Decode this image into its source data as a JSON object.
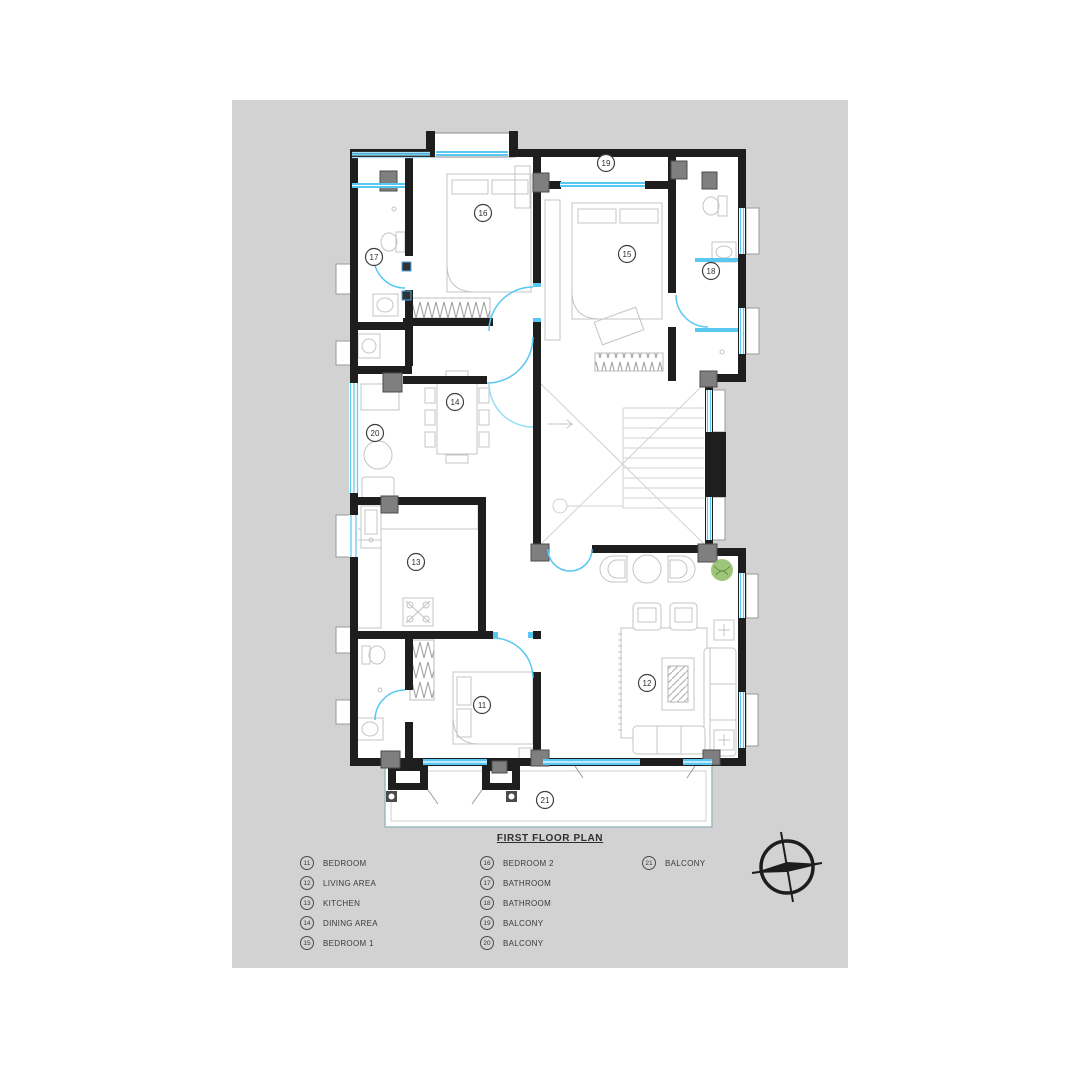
{
  "page": {
    "title": "FIRST FLOOR PLAN"
  },
  "plan": {
    "rooms": [
      {
        "num": "11",
        "label": "BEDROOM",
        "x": 482,
        "y": 705
      },
      {
        "num": "12",
        "label": "LIVING AREA",
        "x": 647,
        "y": 683
      },
      {
        "num": "13",
        "label": "KITCHEN",
        "x": 416,
        "y": 562
      },
      {
        "num": "14",
        "label": "DINING AREA",
        "x": 455,
        "y": 402
      },
      {
        "num": "15",
        "label": "BEDROOM 1",
        "x": 627,
        "y": 254
      },
      {
        "num": "16",
        "label": "BEDROOM 2",
        "x": 483,
        "y": 213
      },
      {
        "num": "17",
        "label": "BATHROOM",
        "x": 374,
        "y": 257
      },
      {
        "num": "18",
        "label": "BATHROOM",
        "x": 711,
        "y": 271
      },
      {
        "num": "19",
        "label": "BALCONY",
        "x": 606,
        "y": 163
      },
      {
        "num": "20",
        "label": "BALCONY",
        "x": 375,
        "y": 433
      },
      {
        "num": "21",
        "label": "BALCONY",
        "x": 545,
        "y": 800
      }
    ]
  },
  "legend": {
    "columns": [
      {
        "items": [
          {
            "num": "11",
            "label": "BEDROOM"
          },
          {
            "num": "12",
            "label": "LIVING AREA"
          },
          {
            "num": "13",
            "label": "KITCHEN"
          },
          {
            "num": "14",
            "label": "DINING AREA"
          },
          {
            "num": "15",
            "label": "BEDROOM 1"
          }
        ]
      },
      {
        "items": [
          {
            "num": "16",
            "label": "BEDROOM 2"
          },
          {
            "num": "17",
            "label": "BATHROOM"
          },
          {
            "num": "18",
            "label": "BATHROOM"
          },
          {
            "num": "19",
            "label": "BALCONY"
          },
          {
            "num": "20",
            "label": "BALCONY"
          }
        ]
      },
      {
        "items": [
          {
            "num": "21",
            "label": "BALCONY"
          }
        ]
      }
    ]
  },
  "colors": {
    "paper": "#d2d2d2",
    "wall": "#1e1e1e",
    "window": "#58c8f2",
    "window_light": "#a8e0f7",
    "column": "#7f7f7f",
    "furniture": "#c4c4c4",
    "stair_line": "#d2d2d2",
    "plant": "#8cbc63",
    "text": "#2e2e2e"
  }
}
